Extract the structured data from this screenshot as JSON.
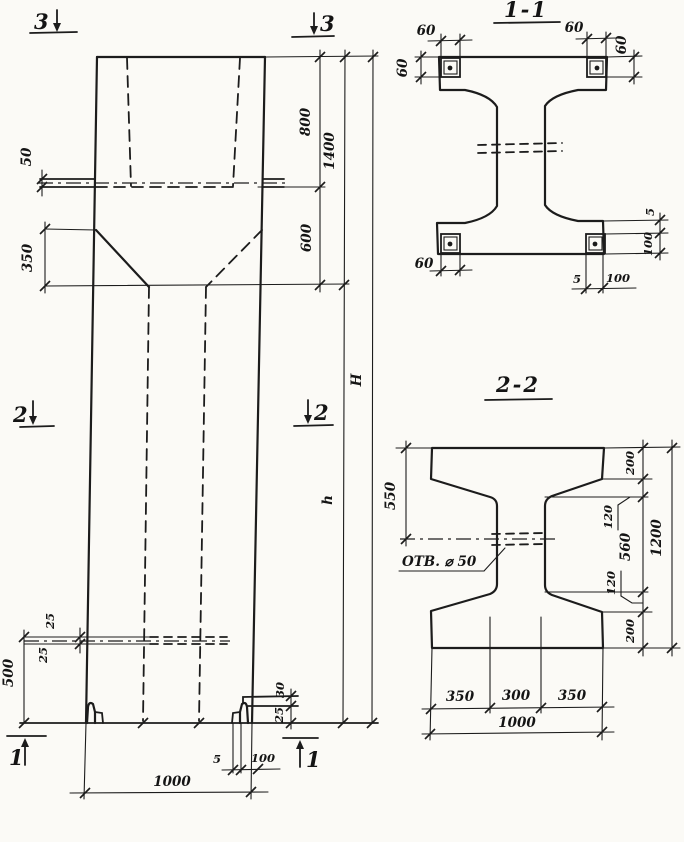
{
  "drawing": {
    "elevation": {
      "section_marks": {
        "top_left": "3",
        "top_right": "3",
        "mid_left": "2",
        "mid_right": "2",
        "bottom_left": "1",
        "bottom_right": "1"
      },
      "dimensions": {
        "ledge_thickness": "50",
        "taper_height": "350",
        "top_segment": "800",
        "upper_segment": "1400",
        "neck_segment": "600",
        "overall_height": "H",
        "shaft_height": "h",
        "slot_top": "25",
        "slot_bottom": "25",
        "base_segment": "500",
        "foot_step": "30",
        "foot_height": "25",
        "shoe_thickness": "5",
        "shoe_width": "100",
        "column_width": "1000"
      }
    },
    "section_1_1": {
      "title": "1-1",
      "dimensions": {
        "plate_top_left_width": "60",
        "plate_top_left_height": "60",
        "plate_top_right_width": "60",
        "plate_top_right_height": "60",
        "plate_bottom_left_width": "60",
        "shoe_gap": "5",
        "shoe_width": "100",
        "shoe_side_gap": "5",
        "shoe_side_width": "100"
      }
    },
    "section_2_2": {
      "title": "2-2",
      "dimensions": {
        "flange_to_hole": "550",
        "hole_note": "ОТВ. ⌀ 50",
        "flange_top": "200",
        "haunch_top": "120",
        "web_height": "560",
        "haunch_bottom": "120",
        "flange_bottom": "200",
        "section_height": "1200",
        "flange_left": "350",
        "web_width": "300",
        "flange_right": "350",
        "section_width": "1000"
      }
    }
  }
}
